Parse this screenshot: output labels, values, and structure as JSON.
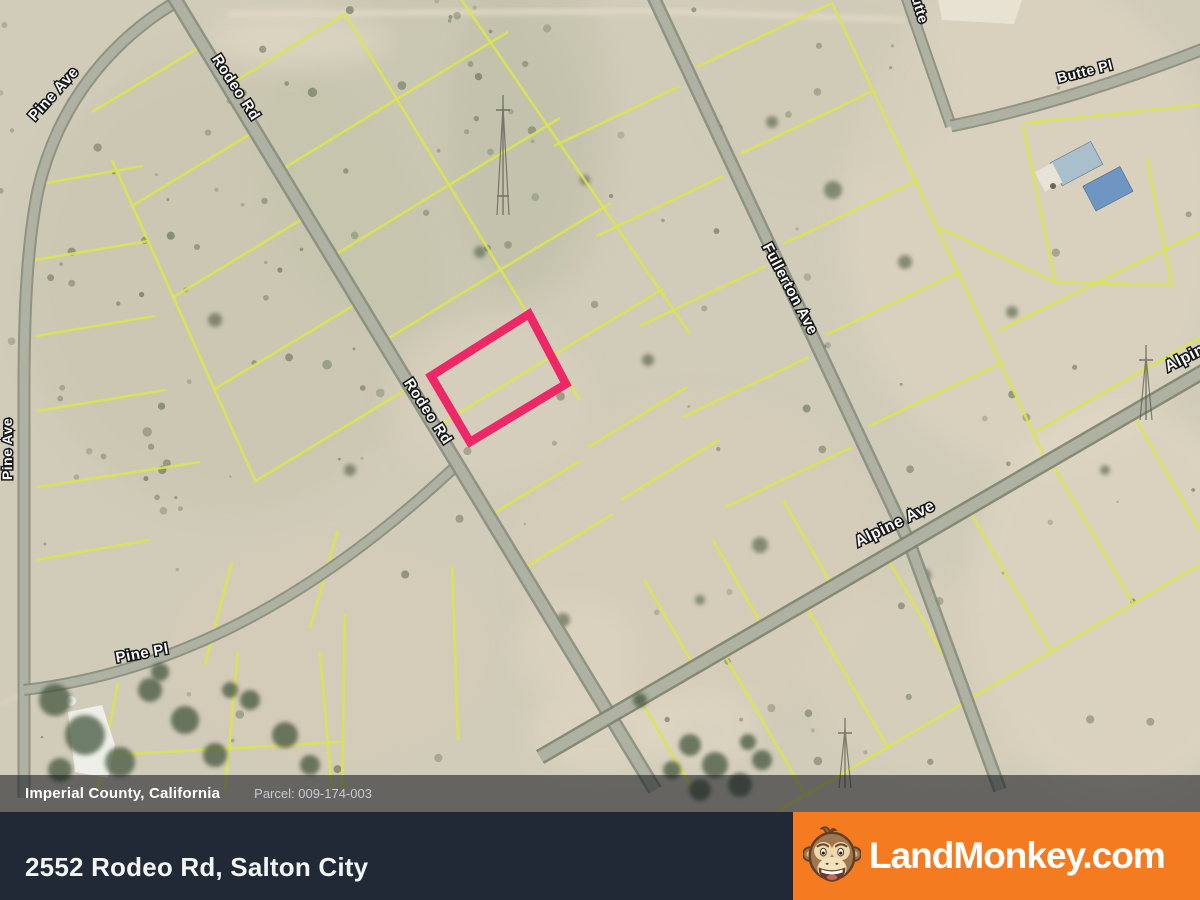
{
  "map": {
    "street_labels": [
      {
        "id": "pine-ave-curve",
        "text": "Pine Ave"
      },
      {
        "id": "rodeo-rd-top",
        "text": "Rodeo Rd"
      },
      {
        "id": "rodeo-rd-mid",
        "text": "Rodeo Rd"
      },
      {
        "id": "pine-ave-left",
        "text": "Pine Ave"
      },
      {
        "id": "pine-pl",
        "text": "Pine Pl"
      },
      {
        "id": "fullerton-ave",
        "text": "Fullerton Ave"
      },
      {
        "id": "alpine-ave",
        "text": "Alpine Ave"
      },
      {
        "id": "alpine-ave-edge",
        "text": "Alpine Ave"
      },
      {
        "id": "butte",
        "text": "Butte"
      },
      {
        "id": "butte-pl",
        "text": "Butte Pl"
      }
    ],
    "highlight_color": "#ee2866",
    "parcel_line_color": "#dde64e",
    "road_fill_color": "#afb2a2"
  },
  "info_bar": {
    "location": "Imperial County, California",
    "parcel": "Parcel: 009-174-003"
  },
  "address_bar": {
    "address": "2552 Rodeo Rd, Salton City"
  },
  "brand": {
    "name": "LandMonkey.com",
    "logo_icon": "monkey-face-icon",
    "accent_color": "#f57b20"
  }
}
